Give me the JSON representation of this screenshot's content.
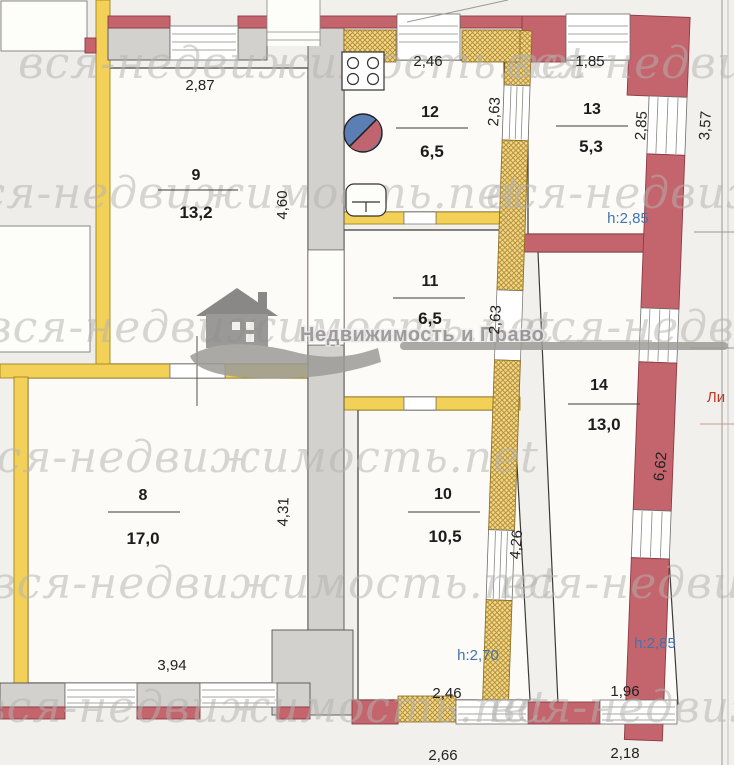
{
  "watermark": {
    "text": "вся-недвижимость.net",
    "logo_text": "Недвижимость и Право"
  },
  "rooms": {
    "r8": {
      "number": "8",
      "area": "17,0",
      "dim_bottom": "3,94",
      "dim_right": "4,31"
    },
    "r9": {
      "number": "9",
      "area": "13,2",
      "dim_top": "2,87",
      "dim_right": "4,60"
    },
    "r10": {
      "number": "10",
      "area": "10,5",
      "dim_right": "4,26",
      "height": "h:2,70",
      "dim_bottom_out": "2,46",
      "dim_bottom_ext": "2,66"
    },
    "r11": {
      "number": "11",
      "area": "6,5",
      "dim_right": "2,63"
    },
    "r12": {
      "number": "12",
      "area": "6,5",
      "dim_top": "2,46",
      "dim_right": "2,63"
    },
    "r13": {
      "number": "13",
      "area": "5,3",
      "dim_top": "1,85",
      "dim_right": "2,85",
      "dim_out": "3,57",
      "height": "h:2,85"
    },
    "r14": {
      "number": "14",
      "area": "13,0",
      "dim_right_out": "6,62",
      "height": "h:2,85",
      "dim_bottom": "1,96",
      "dim_bottom_ext": "2,18"
    }
  },
  "labels": {
    "liter": "Ли"
  },
  "colors": {
    "wall_red": "#c4646d",
    "wall_yellow": "#f3d158",
    "wall_hatch": "#f2d88c",
    "wall_gray": "#d2d1cd",
    "height_blue": "#3f74b0",
    "liter_red": "#c0392b",
    "sink_blue": "#5b7fb5",
    "sink_red": "#c06570",
    "watermark_gray": "#b4b3af"
  }
}
